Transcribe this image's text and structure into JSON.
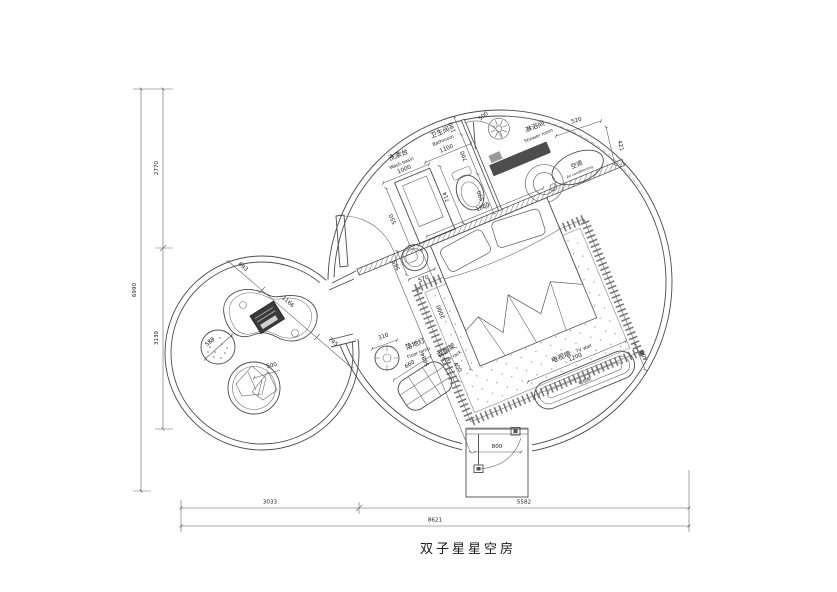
{
  "title": "双子星星空房",
  "labels": {
    "washbasin": {
      "zh": "洗漱台",
      "en": "Wash basin"
    },
    "bathroom": {
      "zh": "卫生间",
      "en": "Bathroom"
    },
    "shower": {
      "zh": "淋浴间",
      "en": "Shower room"
    },
    "ac": {
      "zh": "空调",
      "en": "Air conditioning"
    },
    "floorlamp": {
      "zh": "落地灯",
      "en": "Floor lamp"
    },
    "coatrack": {
      "zh": "衣帽架",
      "en": "Coat rack"
    },
    "tvwall": {
      "zh": "电视墙",
      "en": "TV wall"
    },
    "tvcabinet": {
      "zh": "电视柜"
    }
  },
  "dims": {
    "overall_height": "6990",
    "upper_height": "2770",
    "lower_height": "3139",
    "overall_width": "8621",
    "left_width": "3033",
    "right_width": "5582",
    "washbasin_w": "1000",
    "bathroom_w": "1100",
    "d190": "190",
    "d700": "700",
    "d590": "590",
    "shower_door": "500",
    "d520": "520",
    "d421": "421",
    "d714": "714",
    "d550": "550",
    "d565": "565",
    "d570": "570",
    "bed_w": "1800",
    "bed_l": "2000",
    "d5684": "5684",
    "lamp_310": "310",
    "coat_660": "660",
    "coat_400": "400",
    "tv_1200": "1200",
    "tv_400": "400",
    "door_800": "800",
    "s693": "693",
    "s1166": "1166",
    "s745": "745",
    "pouf_589": "589",
    "cushion_500": "500"
  },
  "colors": {
    "line": "#4a4a4a",
    "dark_fill": "#4d4d4d",
    "text": "#1b1b1b",
    "background": "#ffffff"
  }
}
